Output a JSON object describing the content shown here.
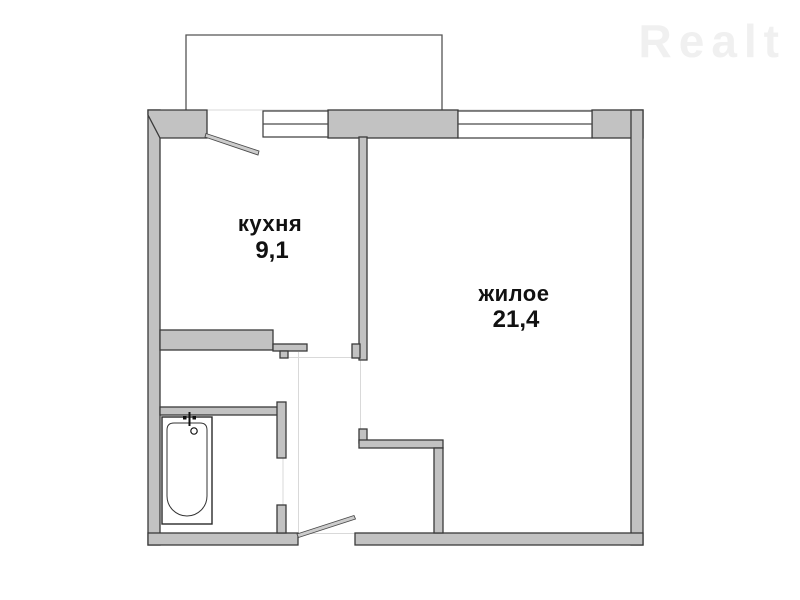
{
  "watermark": {
    "text": "Realt",
    "color": "#f0f0f0"
  },
  "rooms": [
    {
      "name": "кухня",
      "area": "9,1"
    },
    {
      "name": "жилое",
      "area": "21,4"
    }
  ],
  "fixtures": {
    "bathtub_icon": "bathtub-icon",
    "balcony_door_icon": "door-swing-icon",
    "entrance_door_icon": "door-swing-icon",
    "window_icon": "window-icon",
    "balcony_icon": "balcony-outline"
  },
  "colors": {
    "background": "#ffffff",
    "wall_fill": "#c2c2c2",
    "wall_outline": "#3a3a3a",
    "label_text": "#111111",
    "watermark": "#f0f0f0"
  }
}
